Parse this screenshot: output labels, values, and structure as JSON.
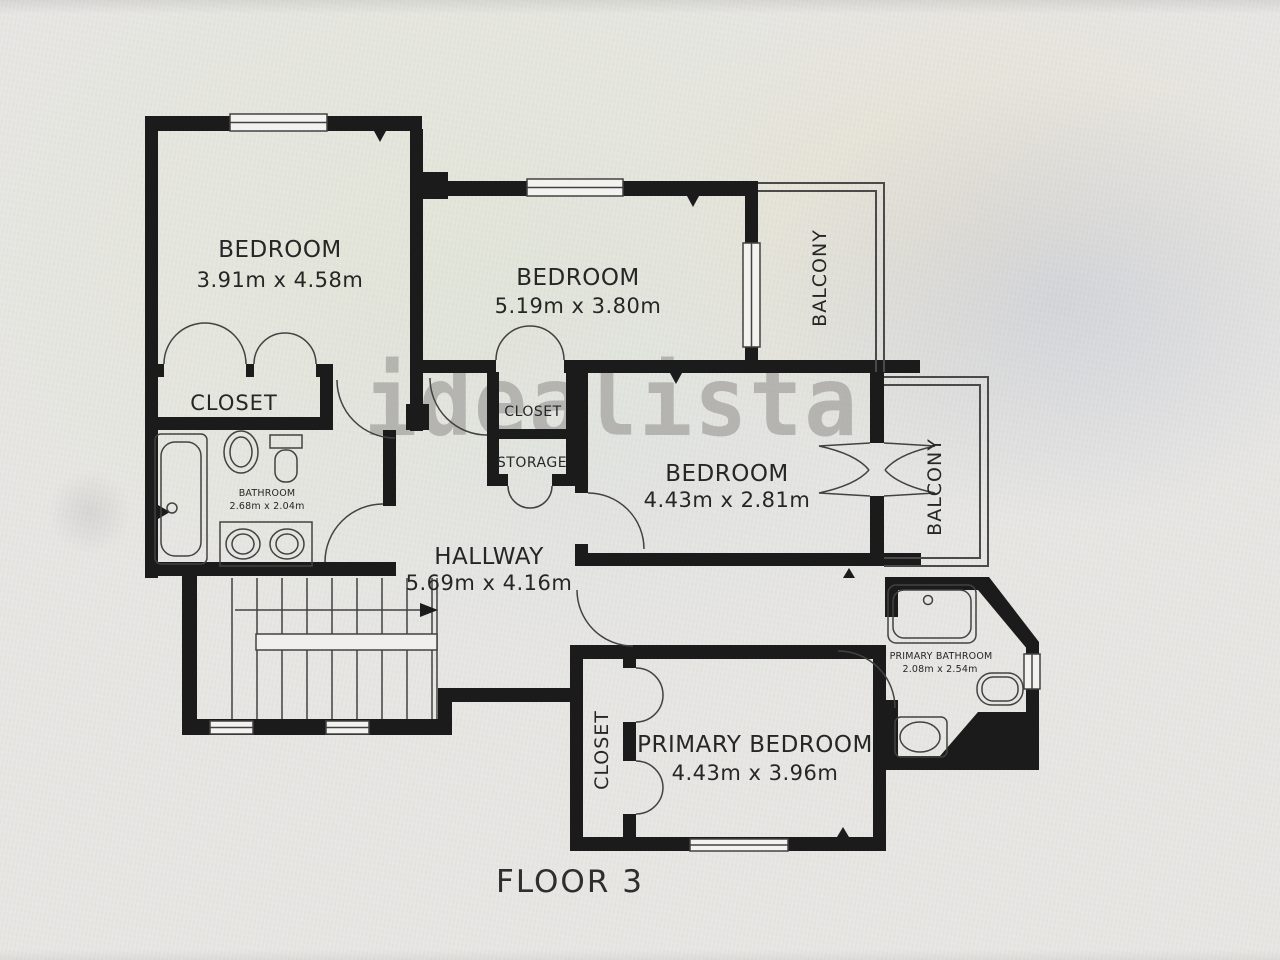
{
  "title": {
    "floor_label": "FLOOR 3"
  },
  "watermark": "idealista",
  "colors": {
    "wall": "#1b1b1b",
    "background": "#e7e6e3",
    "line": "#424242",
    "watermark_gray": "#a09e9b",
    "text": "#262626"
  },
  "rooms": {
    "bedroom_top_left": {
      "label": "BEDROOM",
      "dimensions": "3.91m x 4.58m"
    },
    "bedroom_top_middle": {
      "label": "BEDROOM",
      "dimensions": "5.19m x 3.80m"
    },
    "bedroom_middle_right": {
      "label": "BEDROOM",
      "dimensions": "4.43m x 2.81m"
    },
    "primary_bedroom": {
      "label": "PRIMARY BEDROOM",
      "dimensions": "4.43m x 3.96m"
    },
    "hallway": {
      "label": "HALLWAY",
      "dimensions": "5.69m x 4.16m"
    },
    "bathroom": {
      "label": "BATHROOM",
      "dimensions": "2.68m x 2.04m"
    },
    "primary_bathroom": {
      "label": "PRIMARY BATHROOM",
      "dimensions": "2.08m x 2.54m"
    },
    "closet_top_left": {
      "label": "CLOSET"
    },
    "closet_center": {
      "label": "CLOSET"
    },
    "storage": {
      "label": "STORAGE"
    },
    "closet_primary": {
      "label": "CLOSET"
    },
    "balcony_top": {
      "label": "BALCONY"
    },
    "balcony_right": {
      "label": "BALCONY"
    }
  }
}
